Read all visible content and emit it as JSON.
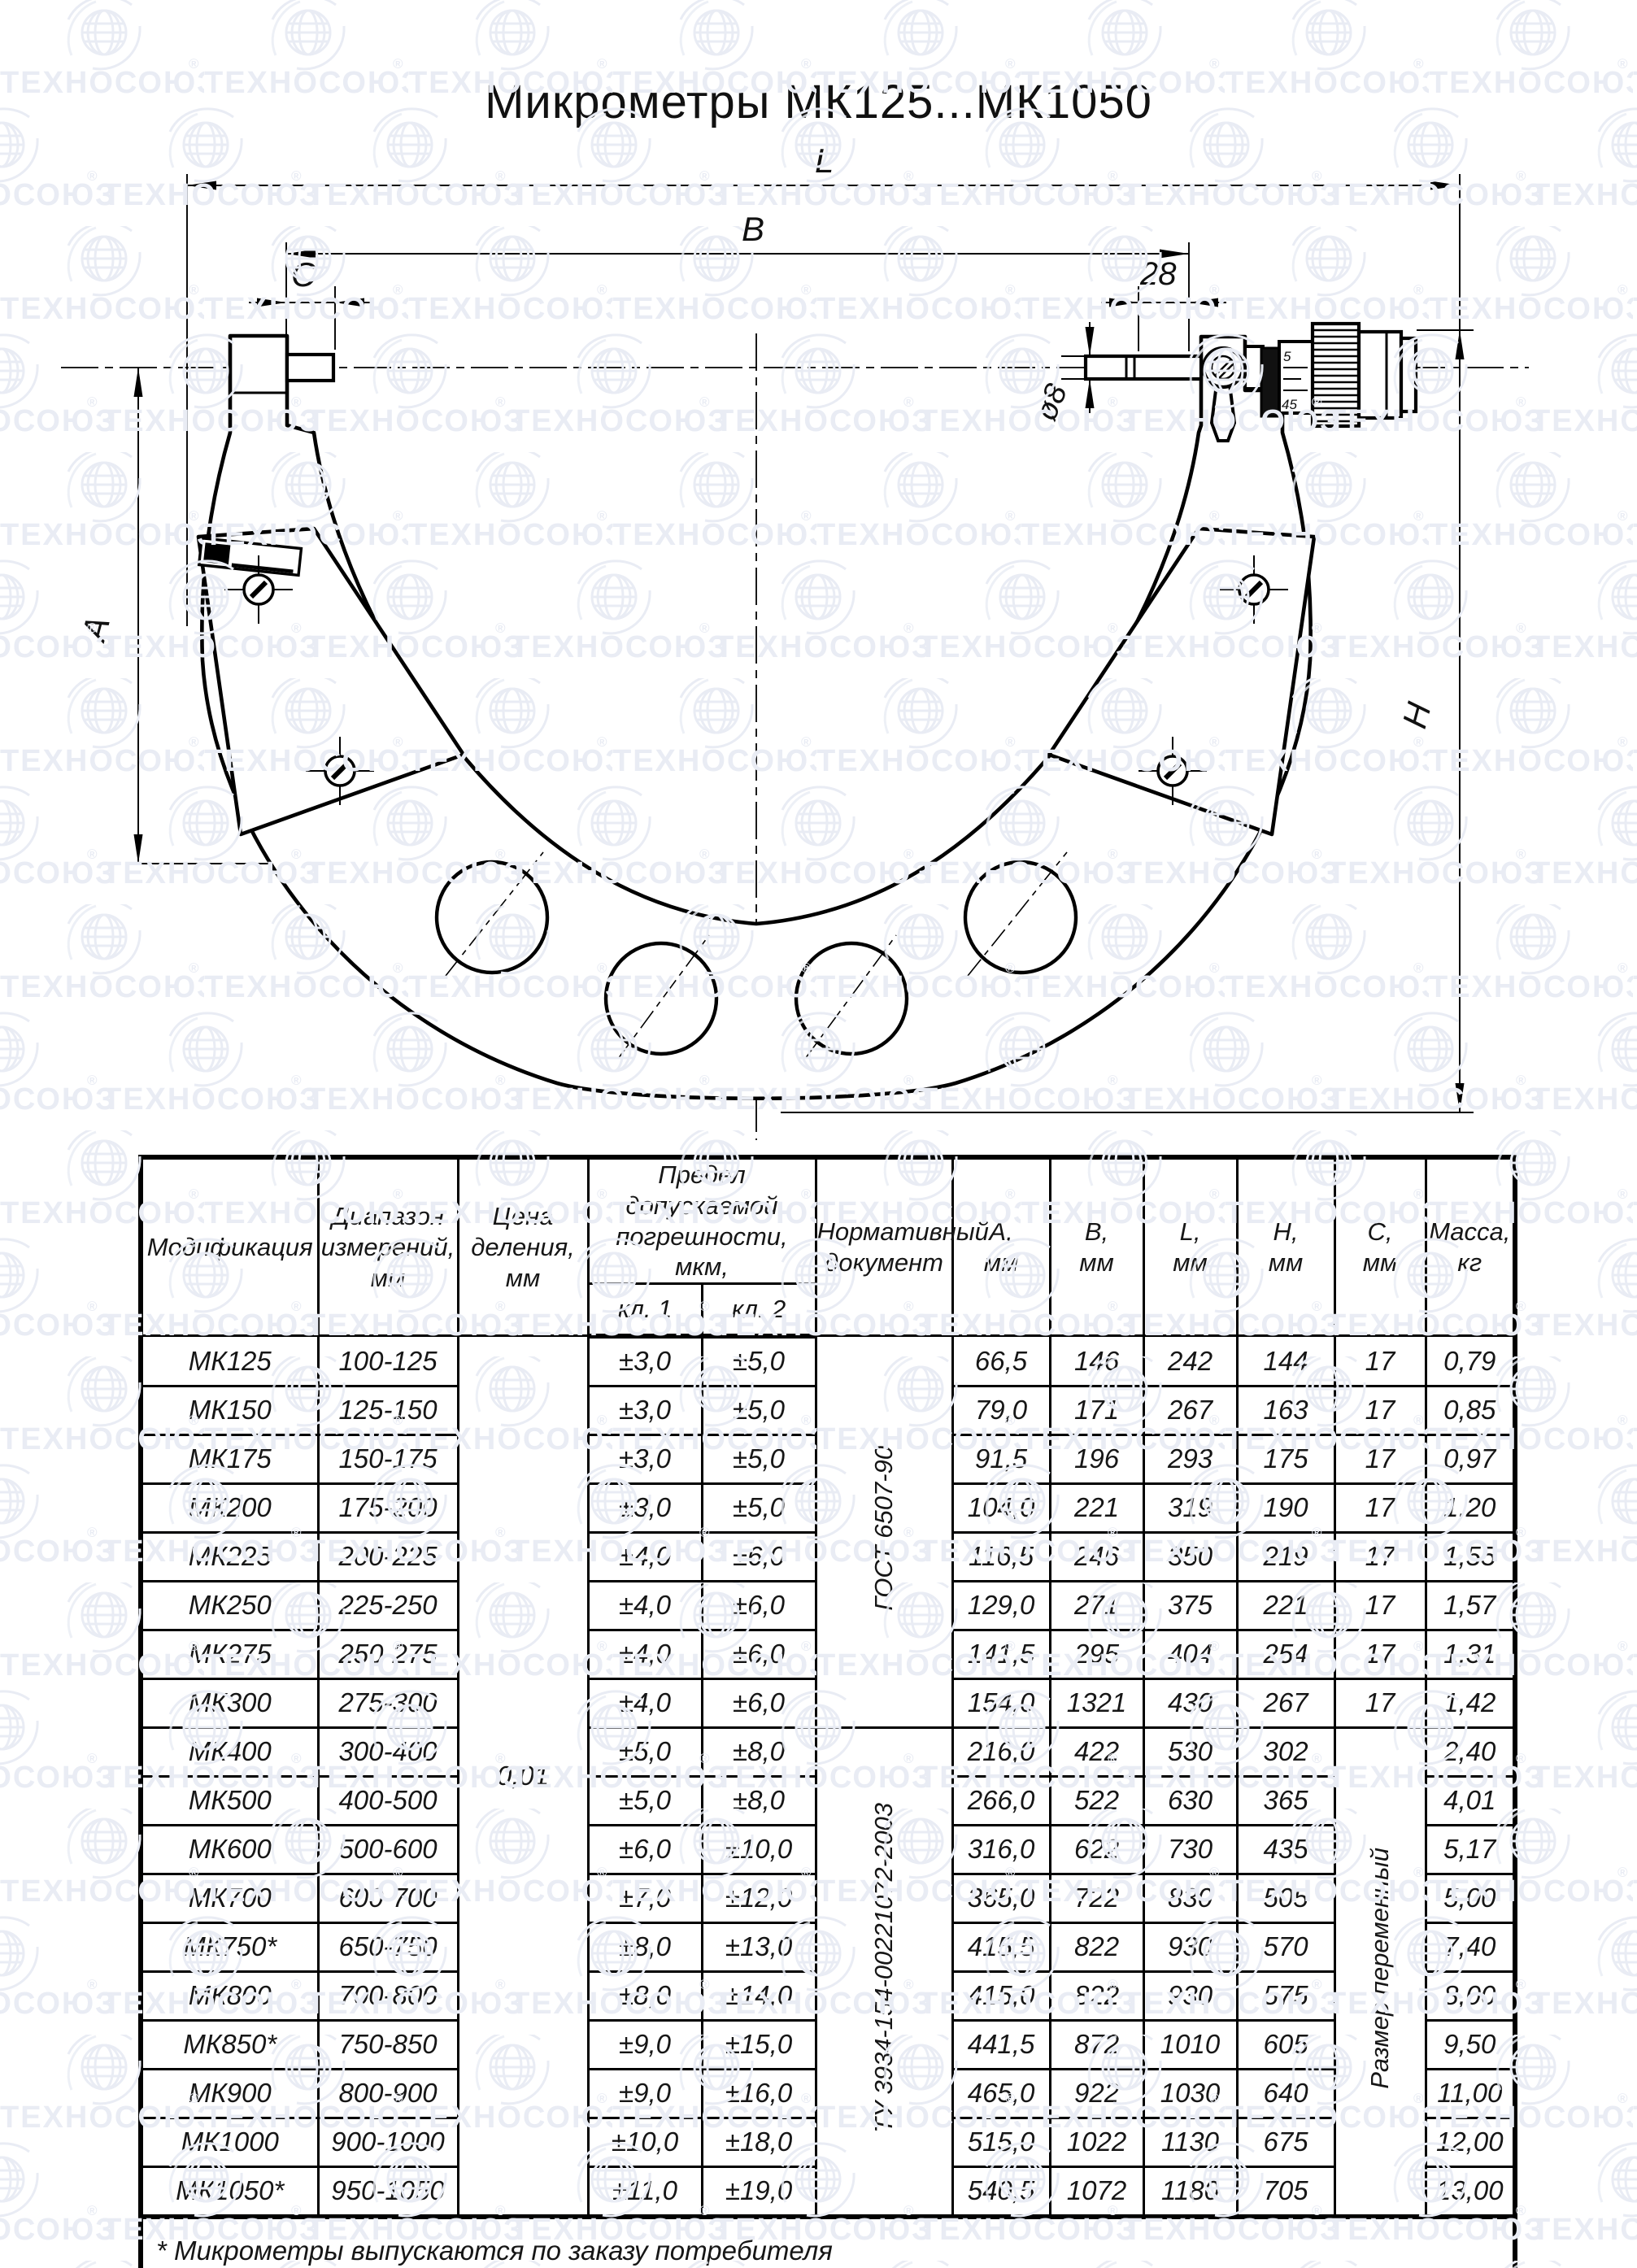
{
  "watermark": {
    "text": "ТЕХНОСОЮЗ",
    "registered": "®"
  },
  "title": "Микрометры МК125...МК1050",
  "drawing": {
    "dims": {
      "L": "L",
      "B": "B",
      "C": "C",
      "d28": "28",
      "dia8": "ø8",
      "A": "A",
      "H": "H"
    },
    "sleeve_marks": {
      "top": "5",
      "bottom": "45"
    }
  },
  "table": {
    "headers": {
      "modification": "Модификация",
      "range": "Диапазон\nизмерений,\nмм",
      "division": "Цена\nделения,\nмм",
      "error_limit": "Предел допускаемой\nпогрешности, мкм,",
      "class1": "кл. 1",
      "class2": "кл. 2",
      "document": "Нормативный\nдокумент",
      "col_a": "А,\nмм",
      "col_b": "В,\nмм",
      "col_l": "L,\nмм",
      "col_h": "Н,\nмм",
      "col_c": "С,\nмм",
      "mass": "Масса,\nкг"
    },
    "division_value": "0,01",
    "documents": [
      {
        "label": "ГОСТ 6507-90",
        "span": 8
      },
      {
        "label": "ТУ 3934-154-00221072-2003",
        "span": 10
      }
    ],
    "c_variable": {
      "label": "Размер переменный",
      "span": 10,
      "start": 8
    },
    "rows": [
      {
        "model": "МК125",
        "range": "100-125",
        "kl1": "±3,0",
        "kl2": "±5,0",
        "a": "66,5",
        "b": "146",
        "l": "242",
        "h": "144",
        "c": "17",
        "mass": "0,79"
      },
      {
        "model": "МК150",
        "range": "125-150",
        "kl1": "±3,0",
        "kl2": "±5,0",
        "a": "79,0",
        "b": "171",
        "l": "267",
        "h": "163",
        "c": "17",
        "mass": "0,85"
      },
      {
        "model": "МК175",
        "range": "150-175",
        "kl1": "±3,0",
        "kl2": "±5,0",
        "a": "91,5",
        "b": "196",
        "l": "293",
        "h": "175",
        "c": "17",
        "mass": "0,97"
      },
      {
        "model": "МК200",
        "range": "175-200",
        "kl1": "±3,0",
        "kl2": "±5,0",
        "a": "104,0",
        "b": "221",
        "l": "319",
        "h": "190",
        "c": "17",
        "mass": "1,20"
      },
      {
        "model": "МК225",
        "range": "200-225",
        "kl1": "±4,0",
        "kl2": "±6,0",
        "a": "116,5",
        "b": "246",
        "l": "350",
        "h": "219",
        "c": "17",
        "mass": "1,55"
      },
      {
        "model": "МК250",
        "range": "225-250",
        "kl1": "±4,0",
        "kl2": "±6,0",
        "a": "129,0",
        "b": "271",
        "l": "375",
        "h": "221",
        "c": "17",
        "mass": "1,57"
      },
      {
        "model": "МК275",
        "range": "250-275",
        "kl1": "±4,0",
        "kl2": "±6,0",
        "a": "141,5",
        "b": "295",
        "l": "404",
        "h": "254",
        "c": "17",
        "mass": "1,31"
      },
      {
        "model": "МК300",
        "range": "275-300",
        "kl1": "±4,0",
        "kl2": "±6,0",
        "a": "154,0",
        "b": "1321",
        "l": "430",
        "h": "267",
        "c": "17",
        "mass": "1,42"
      },
      {
        "model": "МК400",
        "range": "300-400",
        "kl1": "±5,0",
        "kl2": "±8,0",
        "a": "216,0",
        "b": "422",
        "l": "530",
        "h": "302",
        "c": "",
        "mass": "2,40"
      },
      {
        "model": "МК500",
        "range": "400-500",
        "kl1": "±5,0",
        "kl2": "±8,0",
        "a": "266,0",
        "b": "522",
        "l": "630",
        "h": "365",
        "c": "",
        "mass": "4,01"
      },
      {
        "model": "МК600",
        "range": "500-600",
        "kl1": "±6,0",
        "kl2": "±10,0",
        "a": "316,0",
        "b": "622",
        "l": "730",
        "h": "435",
        "c": "",
        "mass": "5,17"
      },
      {
        "model": "МК700",
        "range": "600-700",
        "kl1": "±7,0",
        "kl2": "±12,0",
        "a": "365,0",
        "b": "722",
        "l": "830",
        "h": "505",
        "c": "",
        "mass": "5,00"
      },
      {
        "model": "МК750*",
        "range": "650-750",
        "kl1": "±8,0",
        "kl2": "±13,0",
        "a": "415,5",
        "b": "822",
        "l": "930",
        "h": "570",
        "c": "",
        "mass": "7,40"
      },
      {
        "model": "МК800",
        "range": "700-800",
        "kl1": "±8,0",
        "kl2": "±14,0",
        "a": "415,0",
        "b": "822",
        "l": "930",
        "h": "575",
        "c": "",
        "mass": "8,00"
      },
      {
        "model": "МК850*",
        "range": "750-850",
        "kl1": "±9,0",
        "kl2": "±15,0",
        "a": "441,5",
        "b": "872",
        "l": "1010",
        "h": "605",
        "c": "",
        "mass": "9,50"
      },
      {
        "model": "МК900",
        "range": "800-900",
        "kl1": "±9,0",
        "kl2": "±16,0",
        "a": "465,0",
        "b": "922",
        "l": "1030",
        "h": "640",
        "c": "",
        "mass": "11,00"
      },
      {
        "model": "МК1000",
        "range": "900-1000",
        "kl1": "±10,0",
        "kl2": "±18,0",
        "a": "515,0",
        "b": "1022",
        "l": "1130",
        "h": "675",
        "c": "",
        "mass": "12,00"
      },
      {
        "model": "МК1050*",
        "range": "950-1050",
        "kl1": "±11,0",
        "kl2": "±19,0",
        "a": "540,5",
        "b": "1072",
        "l": "1180",
        "h": "705",
        "c": "",
        "mass": "13,00"
      }
    ],
    "footnote": "* Микрометры выпускаются по заказу потребителя"
  }
}
